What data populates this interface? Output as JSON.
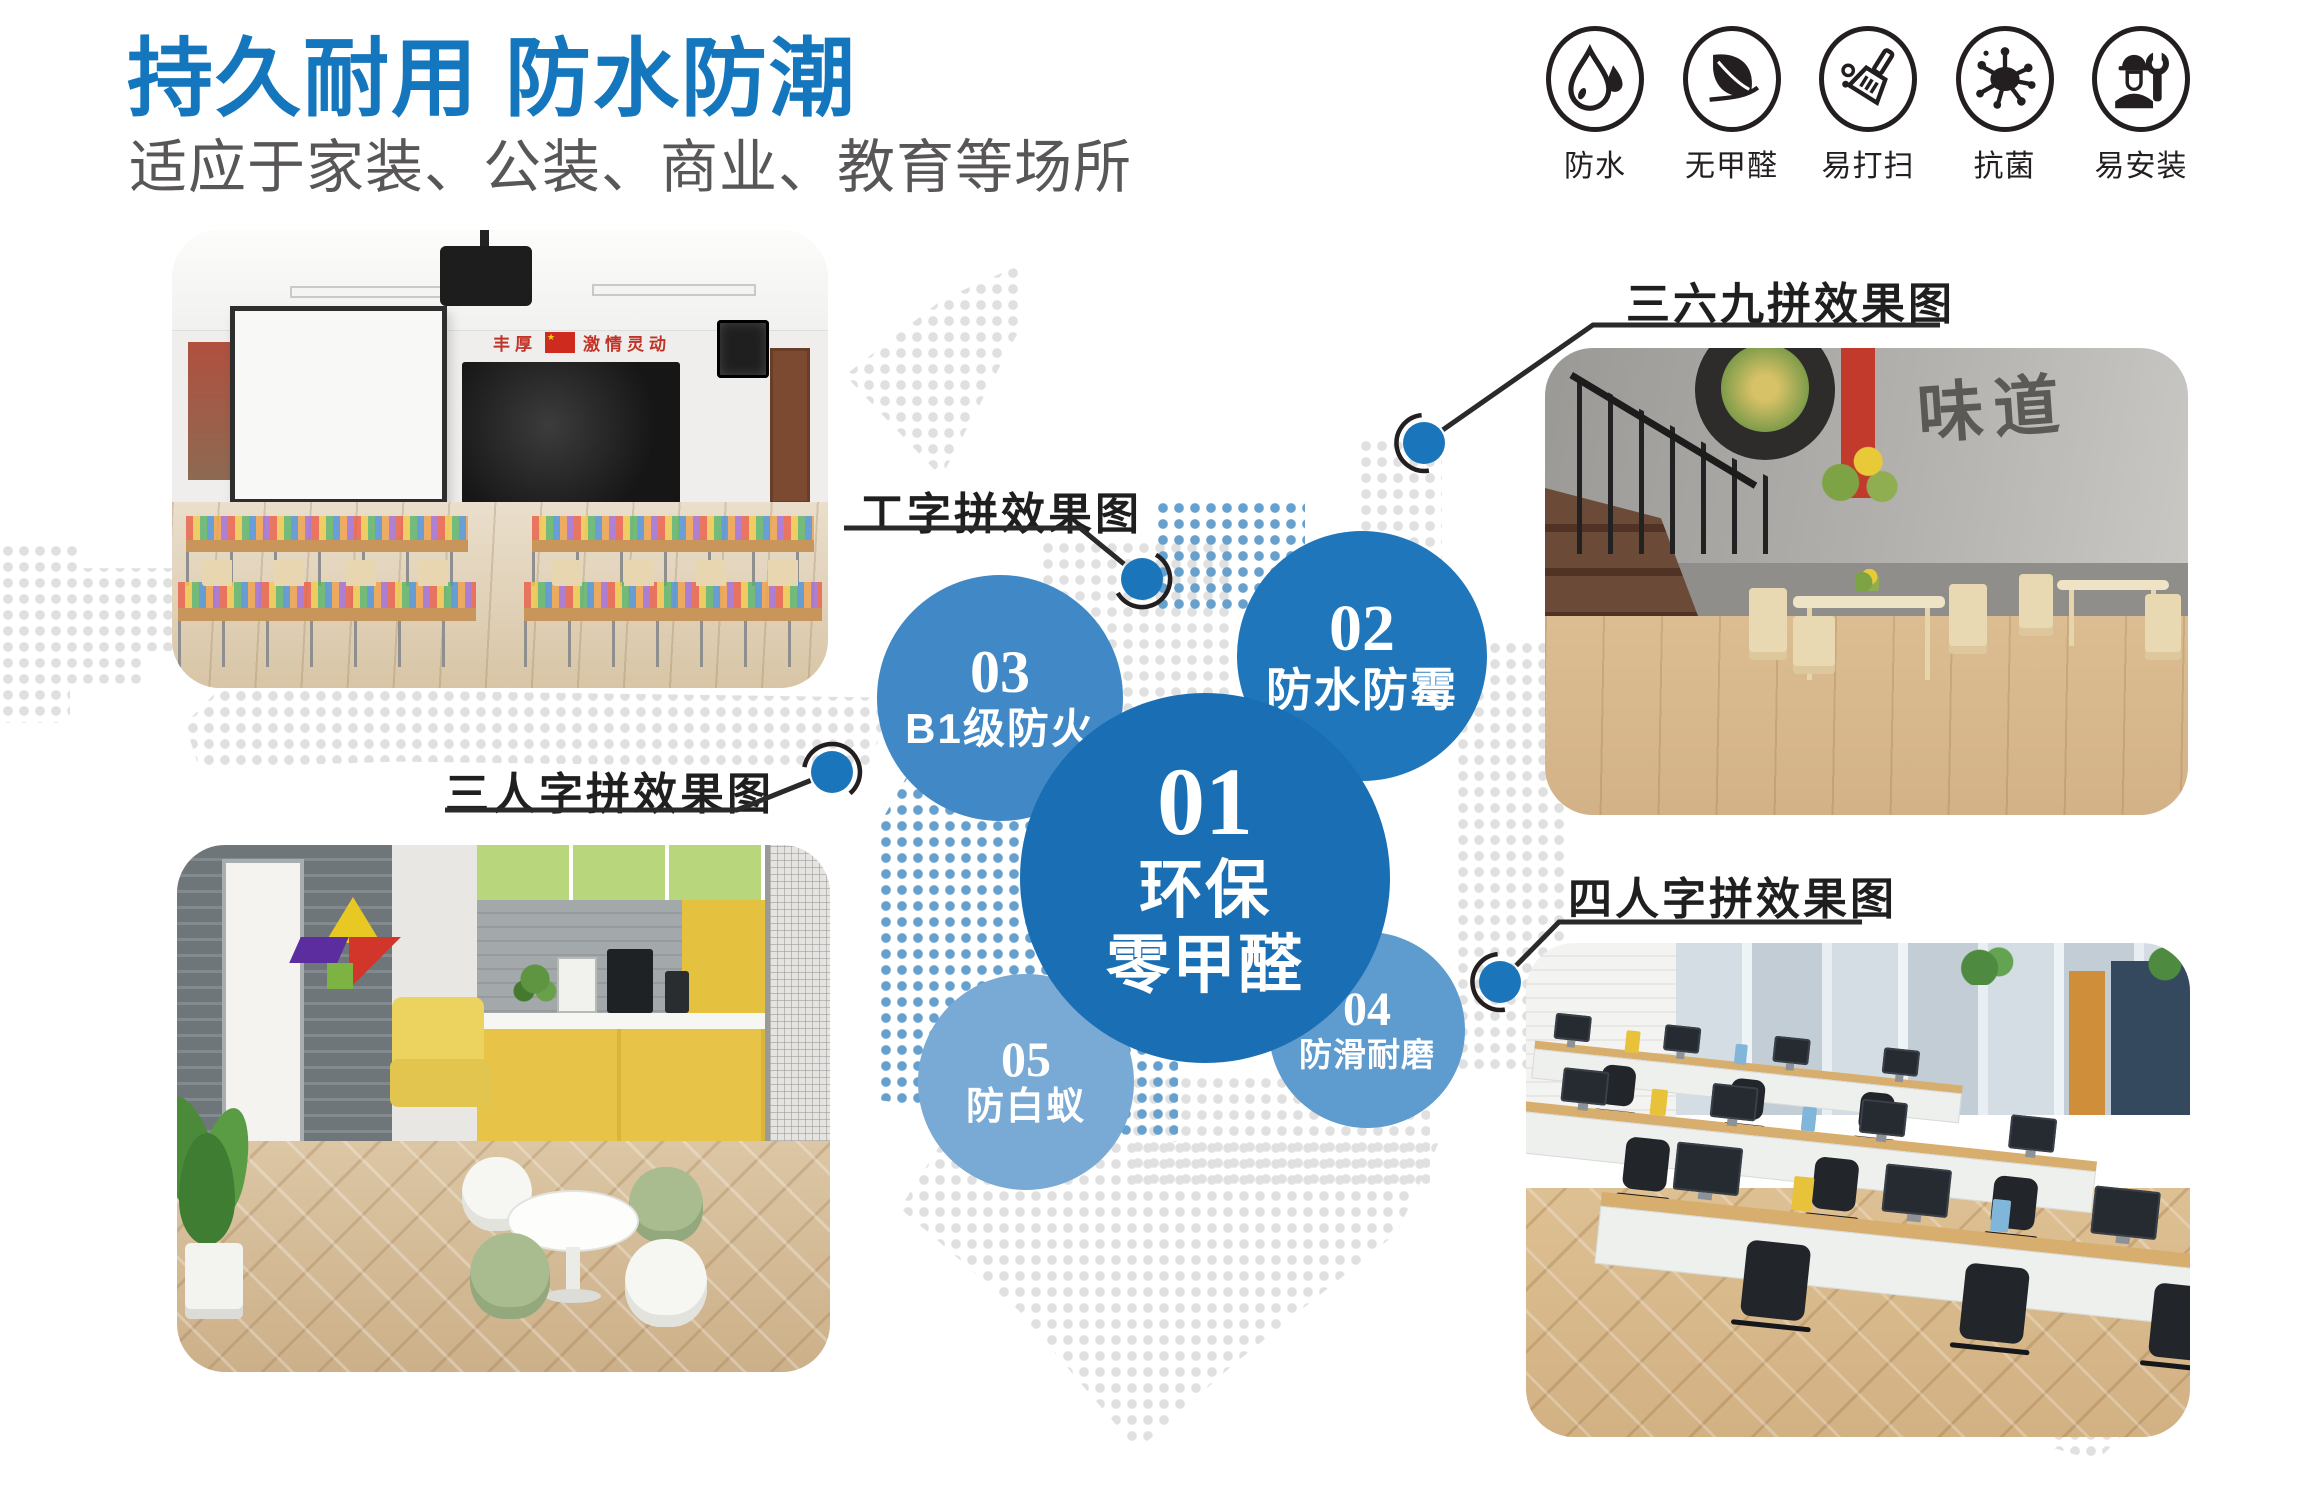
{
  "header": {
    "title": "持久耐用 防水防潮",
    "subtitle": "适应于家装、公装、商业、教育等场所"
  },
  "features": {
    "items": [
      {
        "icon": "water-drop-icon",
        "label": "防水"
      },
      {
        "icon": "leaf-icon",
        "label": "无甲醛"
      },
      {
        "icon": "broom-icon",
        "label": "易打扫"
      },
      {
        "icon": "germ-icon",
        "label": "抗菌"
      },
      {
        "icon": "installer-wrench-icon",
        "label": "易安装"
      }
    ]
  },
  "bubbles": {
    "b1": {
      "number": "01",
      "line1": "环保",
      "line2": "零甲醛"
    },
    "b2": {
      "number": "02",
      "label": "防水防霉"
    },
    "b3": {
      "number": "03",
      "label": "B1级防火"
    },
    "b4": {
      "number": "04",
      "label": "防滑耐磨"
    },
    "b5": {
      "number": "05",
      "label": "防白蚁"
    }
  },
  "callouts": {
    "i_pattern": {
      "label": "工字拼效果图"
    },
    "pattern_369": {
      "label": "三六九拼效果图"
    },
    "herringbone_3": {
      "label": "三人字拼效果图"
    },
    "herringbone_4": {
      "label": "四人字拼效果图"
    }
  },
  "photos": {
    "classroom": {
      "slogan_left": "丰厚",
      "slogan_right": "激情灵动",
      "flag_star": "★"
    },
    "restaurant": {
      "mural_text": "味道"
    },
    "lounge": {},
    "office": {}
  },
  "colors": {
    "accent_blue": "#1476bd",
    "bubble_01": "#1a6eb3",
    "bubble_02": "#1f76bb",
    "bubble_03": "#4189c6",
    "bubble_04": "#5e9bcf",
    "bubble_05": "#79aad5",
    "leader_dot": "#1b75bb",
    "text_gray": "#585656",
    "icon_black": "#231f20",
    "dot_gray": "#e0e0e0",
    "dot_blue": "#66a0ce"
  }
}
